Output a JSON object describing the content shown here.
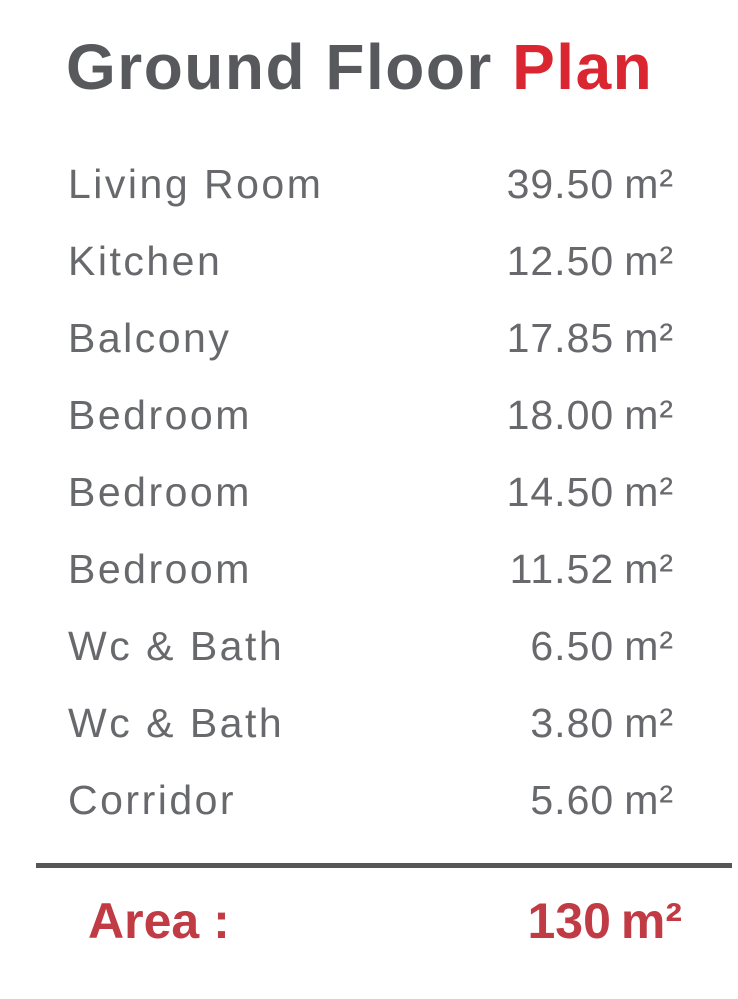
{
  "title": {
    "main": "Ground Floor ",
    "accent": "Plan"
  },
  "rooms": [
    {
      "name": "Living Room",
      "area": "39.50",
      "unit": "m²"
    },
    {
      "name": "Kitchen",
      "area": "12.50",
      "unit": "m²"
    },
    {
      "name": "Balcony",
      "area": "17.85",
      "unit": "m²"
    },
    {
      "name": "Bedroom",
      "area": "18.00",
      "unit": "m²"
    },
    {
      "name": "Bedroom",
      "area": "14.50",
      "unit": "m²"
    },
    {
      "name": "Bedroom",
      "area": "11.52",
      "unit": "m²"
    },
    {
      "name": "Wc & Bath",
      "area": "6.50",
      "unit": "m²"
    },
    {
      "name": "Wc & Bath",
      "area": "3.80",
      "unit": "m²"
    },
    {
      "name": "Corridor",
      "area": "5.60",
      "unit": "m²"
    }
  ],
  "total": {
    "label": "Area :",
    "value": "130",
    "unit": "m²"
  },
  "colors": {
    "text_gray": "#68696c",
    "title_gray": "#58595c",
    "accent_red": "#da2630",
    "total_red": "#c13b44",
    "divider_gray": "#565658",
    "page_bg": "#ffffff"
  }
}
